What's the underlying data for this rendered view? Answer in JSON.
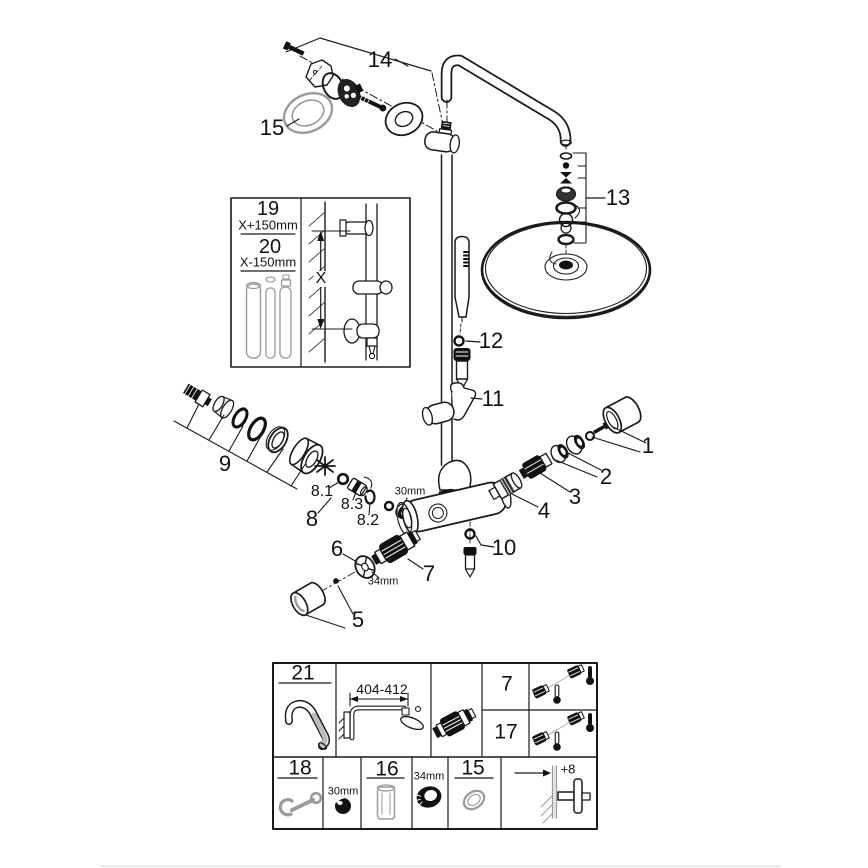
{
  "diagram": {
    "kind": "exploded parts diagram",
    "subject": "thermostatic shower system with rain head and hand shower"
  },
  "colors": {
    "line": "#1a1a1a",
    "muted": "#9a9a9a",
    "background": "#ffffff"
  },
  "callouts": {
    "p1": "1",
    "p2": "2",
    "p3": "3",
    "p4": "4",
    "p5": "5",
    "p6": "6",
    "p7": "7",
    "p8": "8",
    "p8_1": "8.1",
    "p8_2": "8.2",
    "p8_3": "8.3",
    "p9": "9",
    "p10": "10",
    "p11": "11",
    "p12": "12",
    "p13": "13",
    "p14": "14",
    "p15": "15"
  },
  "dims": {
    "valve_nut": "30mm",
    "wheel_nut": "34mm"
  },
  "inset": {
    "item19": "19",
    "item19_dim": "X+150mm",
    "item20": "20",
    "item20_dim": "X-150mm",
    "height_ref": "X"
  },
  "table": {
    "row1": {
      "item21": "21",
      "arm_length": "404-412",
      "item7": "7",
      "item17": "17"
    },
    "row2": {
      "item18": "18",
      "nut": "30mm",
      "item16": "16",
      "ring_nut": "34mm",
      "item15": "15",
      "wall_offset": "+8"
    }
  }
}
